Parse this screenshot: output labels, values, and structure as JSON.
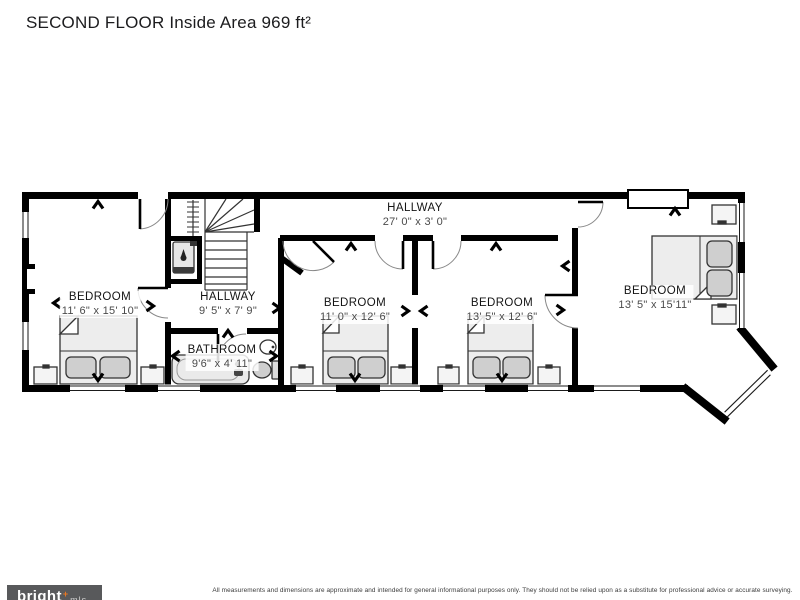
{
  "title": "SECOND FLOOR Inside Area 969 ft²",
  "rooms": [
    {
      "id": "hallway-main",
      "name": "HALLWAY",
      "dims": "27' 0\" x 3' 0\""
    },
    {
      "id": "bedroom-left",
      "name": "BEDROOM",
      "dims": "11' 6\" x 15' 10\""
    },
    {
      "id": "hallway-upper",
      "name": "HALLWAY",
      "dims": "9' 5\" x 7' 9\""
    },
    {
      "id": "bathroom",
      "name": "BATHROOM",
      "dims": "9'6\" x 4' 11\""
    },
    {
      "id": "bedroom-mid-left",
      "name": "BEDROOM",
      "dims": "11' 0\" x 12' 6\""
    },
    {
      "id": "bedroom-mid-right",
      "name": "BEDROOM",
      "dims": "13' 5\" x 12' 6\""
    },
    {
      "id": "bedroom-right",
      "name": "BEDROOM",
      "dims": "13' 5\" x 15'11\""
    }
  ],
  "footer": {
    "logo_text": "bright",
    "logo_accent": "+",
    "logo_suffix": "mls",
    "disclaimer": "All measurements and dimensions are approximate and intended for general informational purposes only. They should not be relied upon as a substitute for professional advice or accurate surveying."
  },
  "icons": {
    "chevron_markers": "door-and-window-direction-chevrons",
    "water_heater": "droplet",
    "fixtures": [
      "bathtub",
      "sink",
      "toilet",
      "bed",
      "nightstand",
      "stairs"
    ]
  },
  "colors": {
    "walls": "#000000",
    "accent_orange": "#e87722",
    "footer_bar": "#58595b",
    "furniture_fill": "#ededed",
    "pillow_fill": "#cfcfcf"
  }
}
